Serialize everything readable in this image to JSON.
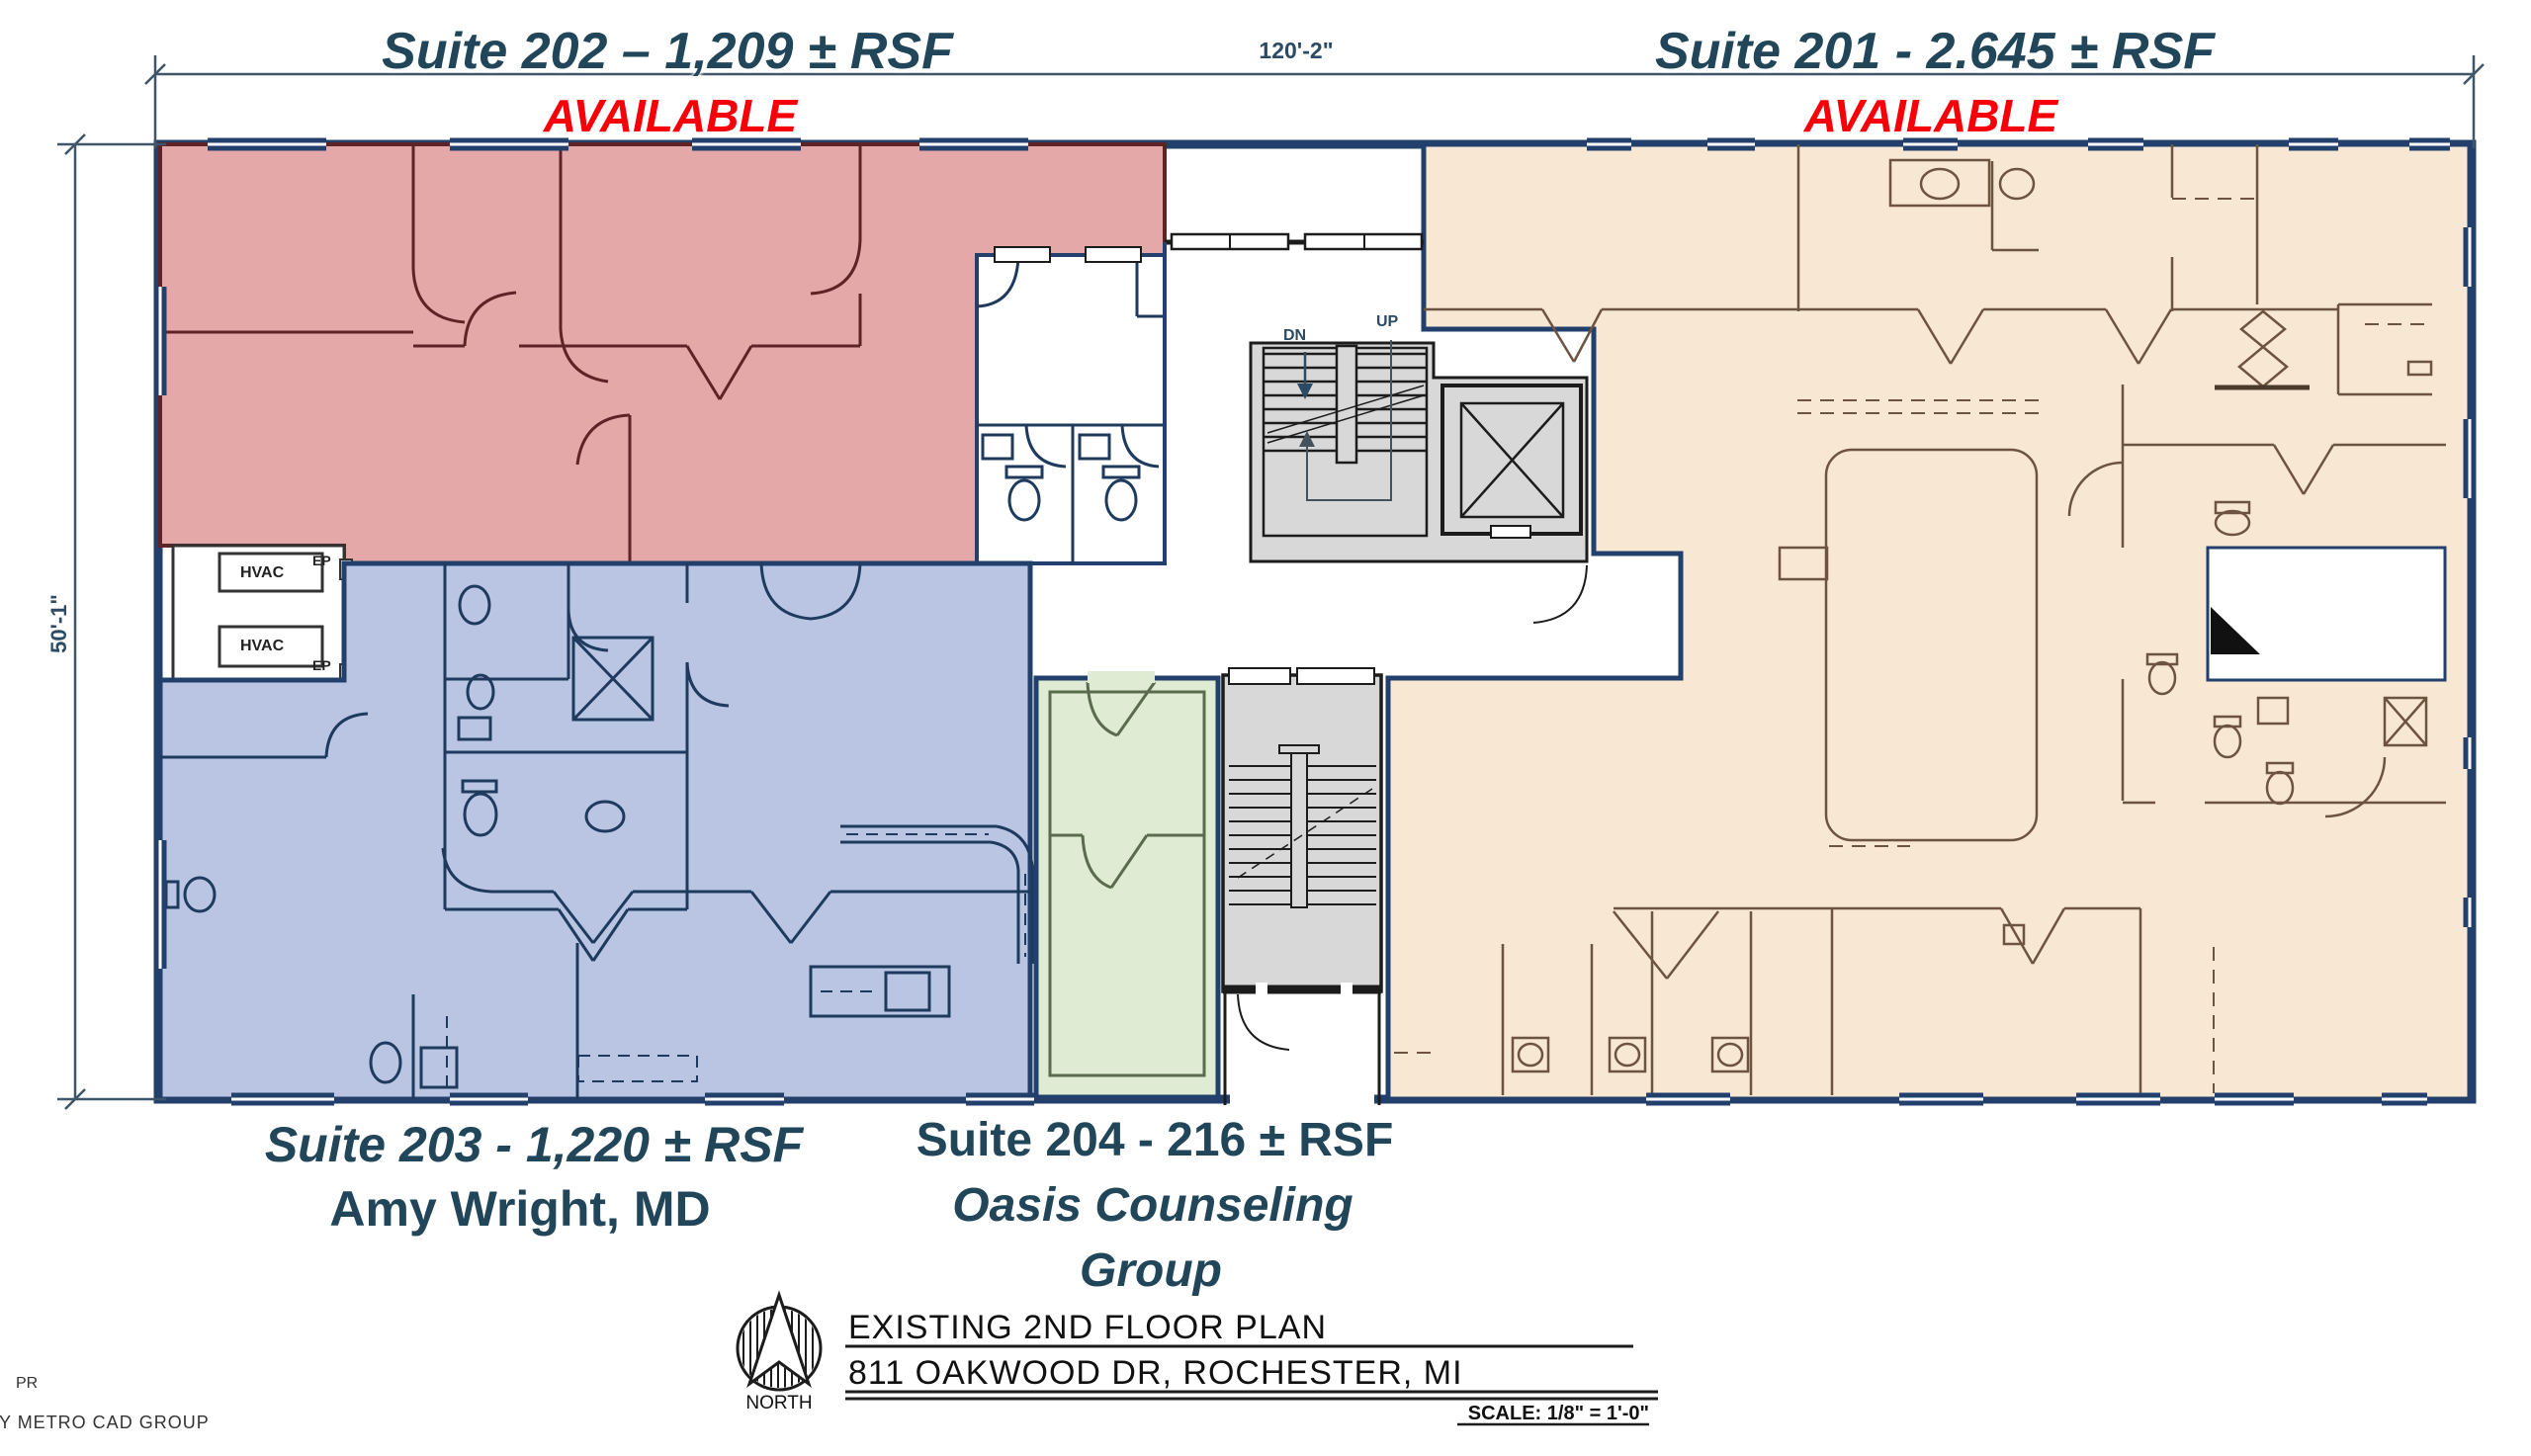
{
  "colors": {
    "wall_navy": "#22406b",
    "suite202_fill": "#e4a8a9",
    "suite202_line": "#5e2326",
    "suite203_fill": "#b9c5e3",
    "suite203_line": "#1e3a5c",
    "suite201_fill": "#f8e7d3",
    "suite201_line": "#6d5441",
    "suite204_fill": "#dfecd3",
    "suite204_line": "#5b6b4e",
    "stair_fill": "#d8d8d8",
    "label_navy": "#214659",
    "available_red": "#f60109",
    "dim_navy": "#2c4a63"
  },
  "dimensions": {
    "top": "120'-2\"",
    "left": "50'-1\""
  },
  "suites": {
    "s202": {
      "line1": "Suite 202 – 1,209 ± RSF",
      "status": "AVAILABLE"
    },
    "s201": {
      "line1": "Suite 201 - 2.645 ± RSF",
      "status": "AVAILABLE"
    },
    "s203": {
      "line1": "Suite 203 - 1,220 ± RSF",
      "line2": "Amy Wright, MD"
    },
    "s204": {
      "line1": "Suite 204 - 216 ± RSF",
      "line2": "Oasis Counseling",
      "line3": "Group"
    }
  },
  "annotations": {
    "dn": "DN",
    "up": "UP",
    "hvac": "HVAC",
    "ep": "EP"
  },
  "title_block": {
    "title": "EXISTING 2ND FLOOR PLAN",
    "address": "811 OAKWOOD DR, ROCHESTER, MI",
    "scale": "SCALE: 1/8\" = 1'-0\"",
    "north": "NORTH"
  },
  "credit": {
    "line1": "PR",
    "line2": "BY METRO CAD GROUP"
  }
}
